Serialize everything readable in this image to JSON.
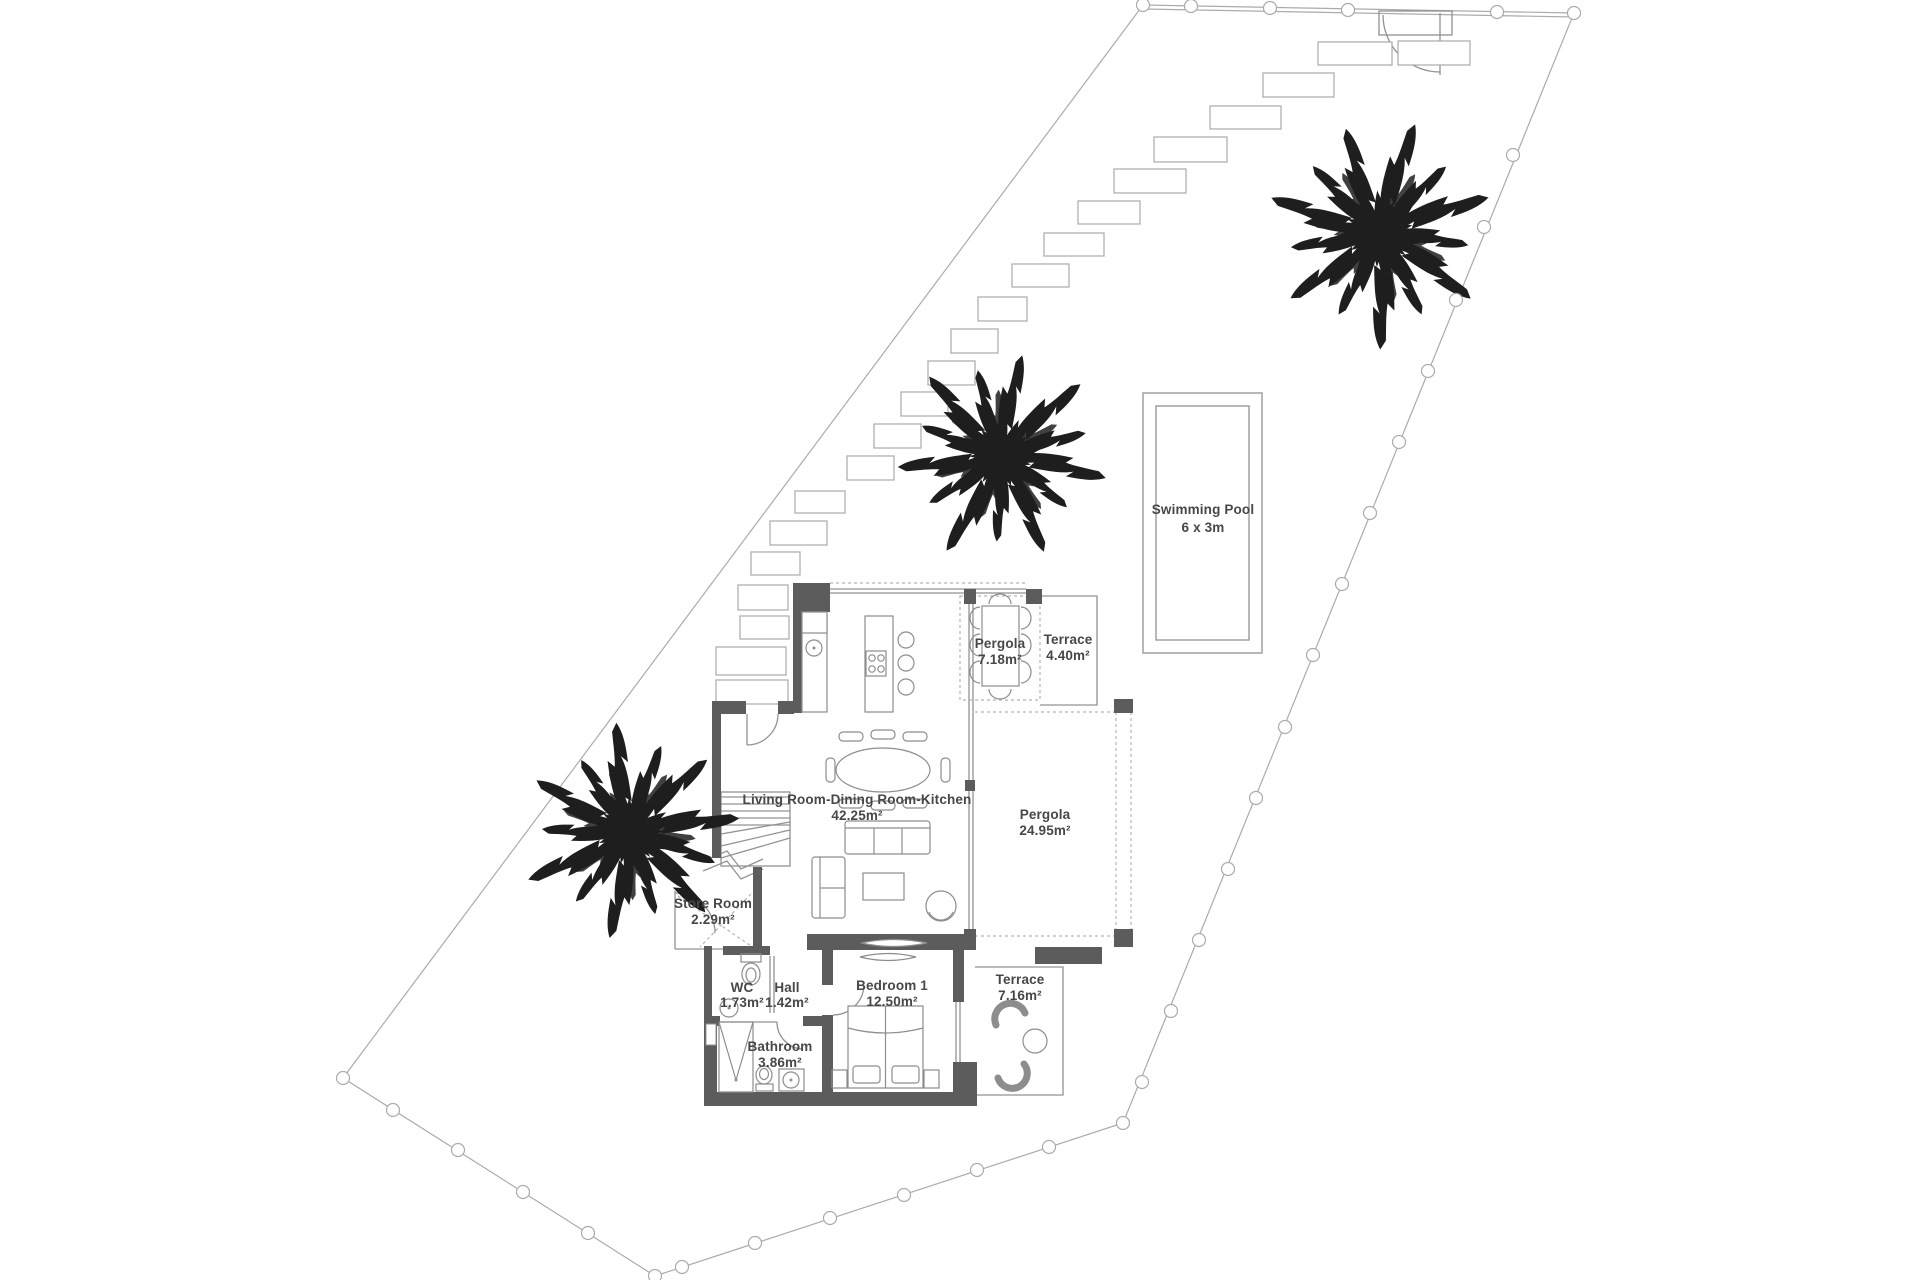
{
  "rooms": {
    "living_kitchen": {
      "name": "Living Room-Dining Room-Kitchen",
      "area": "42.25m²"
    },
    "pergola_small": {
      "name": "Pergola",
      "area": "7.18m²"
    },
    "terrace_small": {
      "name": "Terrace",
      "area": "4.40m²"
    },
    "pergola_large": {
      "name": "Pergola",
      "area": "24.95m²"
    },
    "store_room": {
      "name": "Store Room",
      "area": "2.29m²"
    },
    "wc": {
      "name": "WC",
      "area": "1.73m²"
    },
    "hall": {
      "name": "Hall",
      "area": "1.42m²"
    },
    "bedroom_1": {
      "name": "Bedroom 1",
      "area": "12.50m²"
    },
    "terrace_bedroom": {
      "name": "Terrace",
      "area": "7.16m²"
    },
    "bathroom": {
      "name": "Bathroom",
      "area": "3.86m²"
    },
    "swimming_pool": {
      "name": "Swimming Pool",
      "area": "6 x 3m"
    }
  },
  "colors": {
    "wall": "#5c5c5c",
    "line": "#929292",
    "boundary": "#ababab",
    "tree": "#1e1e1e",
    "text": "#474747",
    "background": "#ffffff"
  }
}
